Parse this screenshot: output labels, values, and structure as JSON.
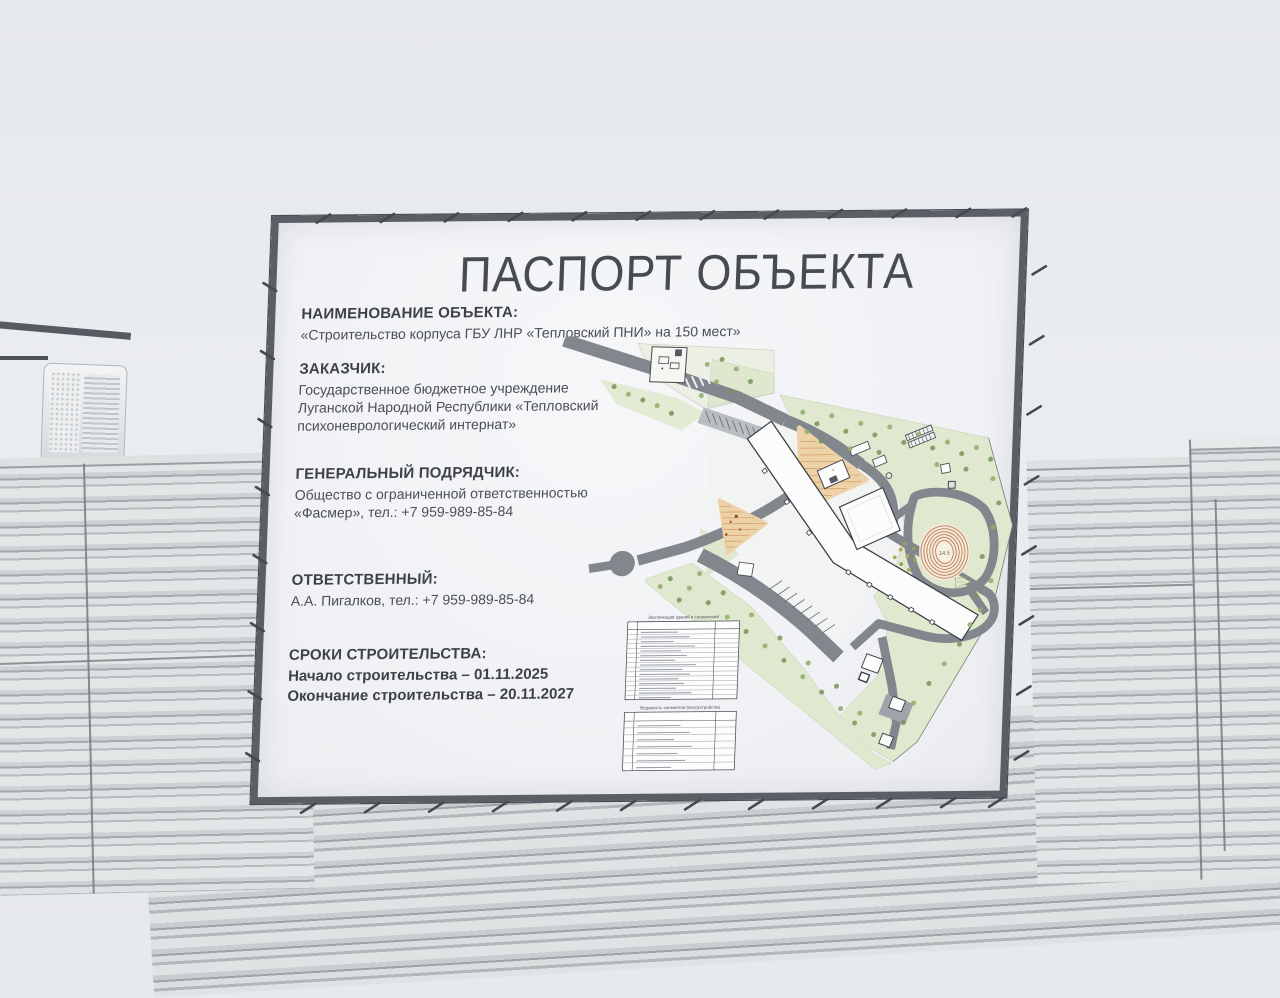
{
  "photo": {
    "board": {
      "title": "ПАСПОРТ ОБЪЕКТА",
      "sections": [
        {
          "heading": "НАИМЕНОВАНИЕ ОБЪЕКТА:",
          "lines": [
            "«Строительство корпуса ГБУ ЛНР «Тепловский ПНИ» на 150 мест»"
          ]
        },
        {
          "heading": "ЗАКАЗЧИК:",
          "lines": [
            "Государственное бюджетное учреждение",
            "Луганской Народной Республики «Тепловский",
            "психоневрологический интернат»"
          ]
        },
        {
          "heading": "ГЕНЕРАЛЬНЫЙ ПОДРЯДЧИК:",
          "lines": [
            "Общество с ограниченной ответственностью",
            "«Фасмер», тел.: +7 959-989-85-84"
          ]
        },
        {
          "heading": "ОТВЕТСТВЕННЫЙ:",
          "lines": [
            "А.А. Пигалков, тел.: +7 959-989-85-84"
          ]
        },
        {
          "heading": "СРОКИ СТРОИТЕЛЬСТВА:",
          "lines": [
            "Начало строительства –  01.11.2025",
            "Окончание строительства –  20.11.2027"
          ]
        }
      ],
      "site_plan": {
        "stadium_label": "14.5",
        "playground_building_label": "4",
        "legend_tables": [
          {
            "title": "Экспликация зданий и сооружений"
          },
          {
            "title": "Ведомость элементов благоустройства"
          }
        ]
      }
    },
    "colors": {
      "banner": "#f2f3f5",
      "frame": "#5a5f66",
      "sky": "#e9ecef",
      "fence_light": "#e2e6e6",
      "fence_dark": "#a4abae",
      "road": "#82878e",
      "green": "#e0e9d0",
      "playground": "#edd2a8",
      "stadium_ring": "#bf7a4f"
    }
  }
}
